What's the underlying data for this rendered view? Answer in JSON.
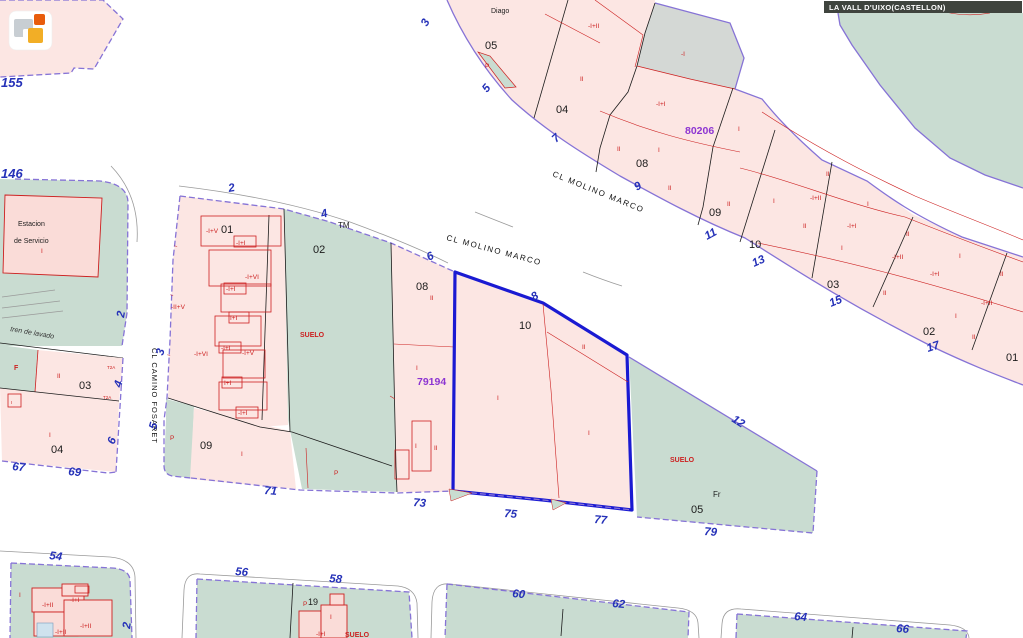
{
  "municipality_bar": {
    "label": "LA VALL D'UIXO(CASTELLON)"
  },
  "map": {
    "street_names": {
      "molino_marco_a": "CL MOLINO MARCO",
      "molino_marco_b": "CL MOLINO MARCO",
      "camino_fosaret": "CL CAMINO FOSARET"
    },
    "place_names": {
      "diago": "Diago",
      "estacion_line1": "Estacion",
      "estacion_line2": "de Servicio",
      "tren_de_lavado": "tren de lavado",
      "tm_mark": "TM",
      "fr_mark": "Fr"
    },
    "parcel_ids": {
      "north_block": "80206",
      "south_block": "79194"
    },
    "parcel_numbers": {
      "n05": "05",
      "n04": "04",
      "n08": "08",
      "n09": "09",
      "n10": "10",
      "n03": "03",
      "n02": "02",
      "n01": "01",
      "s02": "02",
      "s08": "08",
      "s10": "10",
      "s01": "01",
      "s09": "09",
      "s05": "05",
      "w03": "03",
      "w04": "04",
      "b19": "19"
    },
    "house_numbers": {
      "h155": "155",
      "h146": "146",
      "h3": "3",
      "h5": "5",
      "h7": "7",
      "h9": "9",
      "h11": "11",
      "h13": "13",
      "h15": "15",
      "h17": "17",
      "w2": "2",
      "w4": "4",
      "w6": "6",
      "w8": "8",
      "e12": "12",
      "v2": "2",
      "v3": "3",
      "v5": "5",
      "f4": "4",
      "f6": "6",
      "h67": "67",
      "h69": "69",
      "h71": "71",
      "h73": "73",
      "h75": "75",
      "h77": "77",
      "h79": "79",
      "h54": "54",
      "h56": "56",
      "h58": "58",
      "h60": "60",
      "h62": "62",
      "h64": "64",
      "h66": "66",
      "b2": "2"
    },
    "floor_labels": {
      "a1": "-I+II",
      "a2": "II",
      "a3": "-I",
      "a4": "-I+I",
      "a5": "II",
      "a6": "I",
      "a7": "I",
      "a8": "II",
      "a9": "II",
      "a10": "I",
      "a11": "II",
      "a12": "-I+II",
      "a13": "I",
      "a14": "II",
      "a15": "-I+I",
      "a16": "I",
      "a17": "II",
      "a18": "-I+II",
      "a19": "I",
      "a20": "-I+I",
      "a21": "II",
      "a22": "II",
      "a23": "-I+II",
      "a24": "I",
      "a25": "II",
      "a26": "P",
      "b1": "-I+V",
      "b2": "-I+I",
      "b3": "-I+VI",
      "b4": "-I+I",
      "b5": "-II+V",
      "b6": "I+I",
      "b7": "-I+I",
      "b8": "-I+V",
      "b9": "-I+VI",
      "b10": "I+I",
      "b11": "-I+I",
      "c1": "II",
      "c2": "I",
      "c3": "I",
      "c4": "II",
      "c5": "I",
      "c6": "II",
      "c7": "I",
      "c8": "I",
      "c9": "P",
      "c10": "P",
      "d1": "F",
      "d2": "II",
      "d3": "I",
      "d4": "T2A",
      "d5": "T2A",
      "d6": "I",
      "d7": "I",
      "d8": "I",
      "d9": "I",
      "d10": "I",
      "e1": "-I+II",
      "e2": "-I+I",
      "e3": "-I+II",
      "e4": "-I+II",
      "e5": "I",
      "f1": "I",
      "f2": "-I+I",
      "f3": "P"
    },
    "land_labels": {
      "suelo_a": "SUELO",
      "suelo_b": "SUELO",
      "suelo_c": "SUELO"
    }
  },
  "colors": {
    "parcel_pink": "#fce6e3",
    "parcel_green": "#c9dcd1",
    "parcel_gray": "#d4d8d5",
    "boundary_purple": "#8673d6",
    "selected_blue": "#1a1ad2",
    "label_red": "#cc2020",
    "number_blue": "#2531b8",
    "id_purple": "#8d35d2",
    "bar_background": "#3f443e"
  }
}
